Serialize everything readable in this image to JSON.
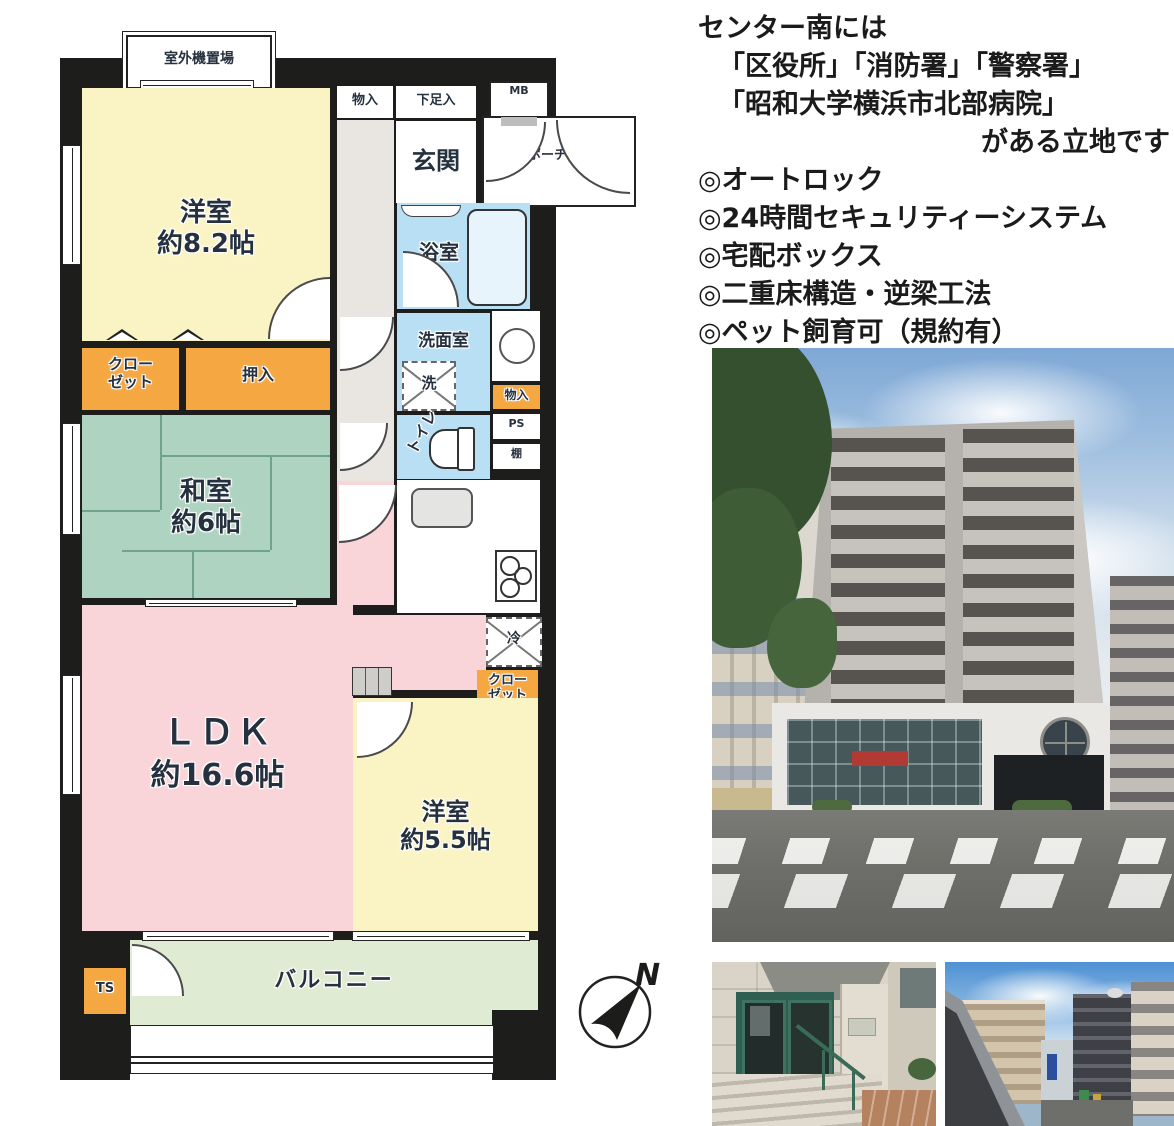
{
  "colors": {
    "wall": "#1d1d1b",
    "western_room": "#FAF4C5",
    "japanese_room": "#AFD3C1",
    "ldk": "#F9D5DA",
    "wet": "#B9DFF4",
    "tub": "#E8F4FB",
    "orange": "#F5A742",
    "balcony": "#DFEBD2",
    "corridor": "#E9E5E1",
    "white": "#FFFFFF"
  },
  "floorplan": {
    "outdoor_unit": "室外機置場",
    "bedroom1_name": "洋室",
    "bedroom1_size": "約8.2帖",
    "storage_top": "物入",
    "shoe_storage": "下足入",
    "entrance": "玄関",
    "meter_box": "MB",
    "porch": "ポーチ",
    "bathroom": "浴室",
    "washroom": "洗面室",
    "washer": "洗",
    "storage_mid": "物入",
    "pipe_space": "PS",
    "shelf": "棚",
    "toilet": "トイレ",
    "closet1": "クロー\nゼット",
    "oshiire": "押入",
    "japanese_room_name": "和室",
    "japanese_room_size": "約6帖",
    "ldk_name": "ＬＤＫ",
    "ldk_size": "約16.6帖",
    "fridge": "冷",
    "closet2": "クロー\nゼット",
    "bedroom2_name": "洋室",
    "bedroom2_size": "約5.5帖",
    "trunk": "TS",
    "balcony_label": "バルコニー",
    "north": "N"
  },
  "description": {
    "line1": "センター南には",
    "line2": "「区役所」「消防署」「警察署」",
    "line3": "「昭和大学横浜市北部病院」",
    "line4": "がある立地です",
    "features": [
      "◎オートロック",
      "◎24時間セキュリティーシステム",
      "◎宅配ボックス",
      "◎二重床構造・逆梁工法",
      "◎ペット飼育可（規約有）"
    ]
  }
}
